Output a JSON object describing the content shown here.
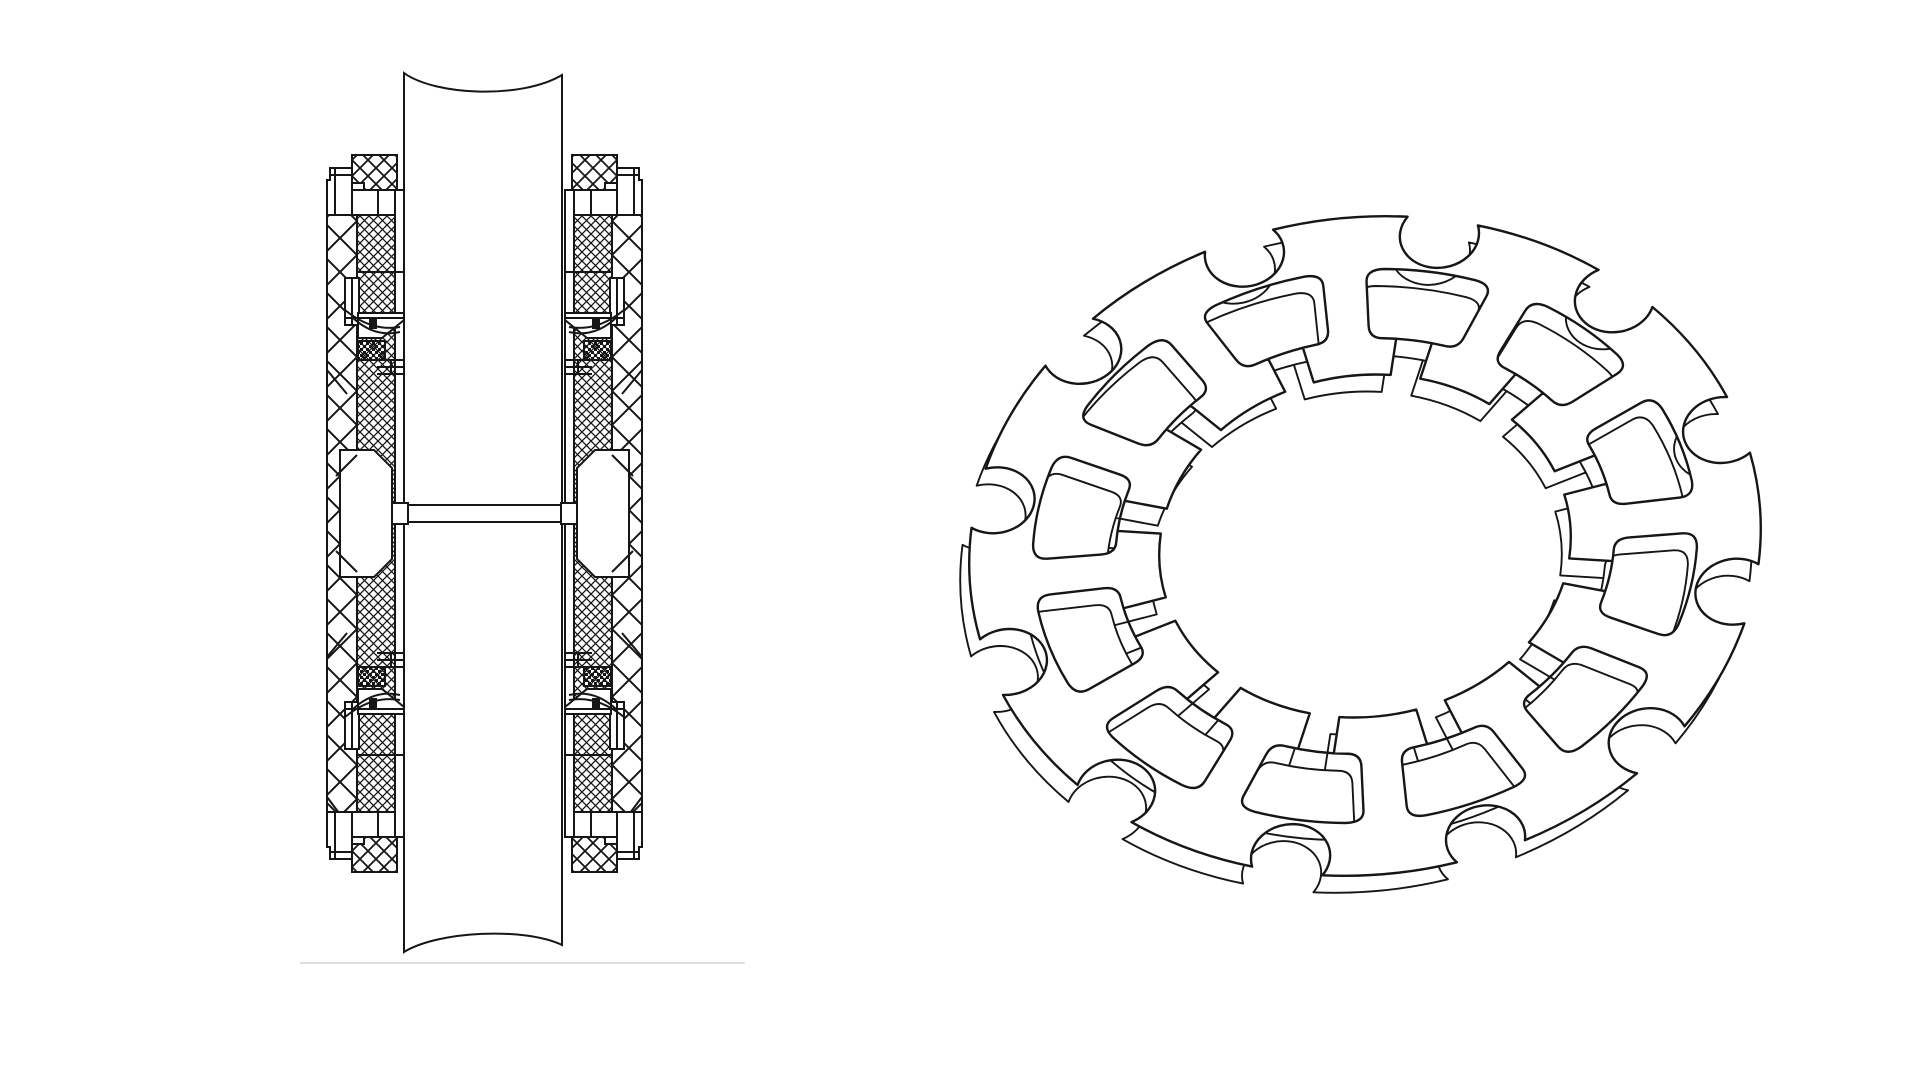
{
  "page": {
    "width": 1920,
    "height": 1080,
    "background": "#ffffff",
    "ink": "#161616"
  },
  "figures": {
    "cross_section": {
      "name": "shaft-seal-assembly-sectional-view",
      "stroke": "#161616",
      "stroke_w": 2,
      "mirror_axis_x": 484.5,
      "mirror_axis_y": 513.5,
      "shaft": {
        "d": "M404,73 C436,96 522,99 562,75 L562,945 C524,927 438,931 404,952 Z"
      },
      "patterns": {
        "big": {
          "size": 34,
          "w": 2.0
        },
        "med": {
          "size": 16,
          "w": 1.8
        },
        "fine": {
          "size": 9,
          "w": 1.3
        },
        "stipple": {
          "size": 6
        }
      },
      "half_shapes": [
        {
          "t": "rect",
          "x": 327,
          "y": 215,
          "w": 30,
          "h": 598,
          "f": "big"
        },
        {
          "t": "rect",
          "x": 357,
          "y": 215,
          "w": 38,
          "h": 598,
          "f": "fine"
        },
        {
          "t": "rect",
          "x": 395,
          "y": 190,
          "w": 9,
          "h": 647,
          "f": "white"
        },
        {
          "t": "path",
          "d": "M340,450 L374,450 L392,468 L392,559 L374,577 L340,577 Z",
          "f": "white"
        },
        {
          "t": "line",
          "x1": 357,
          "y1": 455,
          "x2": 336,
          "y2": 476
        },
        {
          "t": "line",
          "x1": 357,
          "y1": 572,
          "x2": 336,
          "y2": 551
        },
        {
          "t": "line",
          "x1": 327,
          "y1": 370,
          "x2": 347,
          "y2": 394
        },
        {
          "t": "line",
          "x1": 327,
          "y1": 657,
          "x2": 347,
          "y2": 633
        },
        {
          "t": "line",
          "x1": 327,
          "y1": 797,
          "x2": 339,
          "y2": 813
        }
      ],
      "quadrant_shapes": [
        {
          "t": "rect",
          "x": 352,
          "y": 155,
          "w": 45,
          "h": 35,
          "f": "med"
        },
        {
          "t": "rect",
          "x": 352,
          "y": 183,
          "w": 12,
          "h": 7,
          "f": "white"
        },
        {
          "t": "path",
          "d": "M330,168 L352,168 L352,215 L327,215 L327,180 L330,180 Z",
          "f": "white"
        },
        {
          "t": "line",
          "x1": 335,
          "y1": 168,
          "x2": 335,
          "y2": 215
        },
        {
          "t": "line",
          "x1": 330,
          "y1": 175,
          "x2": 352,
          "y2": 175
        },
        {
          "t": "rect",
          "x": 352,
          "y": 190,
          "w": 43,
          "h": 25,
          "f": "white"
        },
        {
          "t": "line",
          "x1": 378,
          "y1": 190,
          "x2": 378,
          "y2": 215
        },
        {
          "t": "line",
          "x1": 357,
          "y1": 272,
          "x2": 404,
          "y2": 272
        },
        {
          "t": "rect",
          "x": 345,
          "y": 278,
          "w": 14,
          "h": 47,
          "f": "white"
        },
        {
          "t": "line",
          "x1": 352,
          "y1": 278,
          "x2": 352,
          "y2": 325
        },
        {
          "t": "path",
          "d": "M358,313 L404,313 L404,320 L382,338 L358,338 Z",
          "f": "white"
        },
        {
          "t": "line",
          "x1": 345,
          "y1": 318,
          "x2": 404,
          "y2": 318
        },
        {
          "t": "rect",
          "x": 369,
          "y": 319,
          "w": 8,
          "h": 10,
          "f": "dark"
        },
        {
          "t": "path",
          "d": "M345,310 Q372,332 400,327",
          "f": "none"
        },
        {
          "t": "path",
          "d": "M352,317 Q374,338 400,332",
          "f": "none"
        },
        {
          "t": "rect",
          "x": 358,
          "y": 341,
          "w": 27,
          "h": 19,
          "f": "stip"
        },
        {
          "t": "line",
          "x1": 377,
          "y1": 360,
          "x2": 404,
          "y2": 360
        },
        {
          "t": "line",
          "x1": 377,
          "y1": 367,
          "x2": 404,
          "y2": 367
        },
        {
          "t": "line",
          "x1": 377,
          "y1": 374,
          "x2": 404,
          "y2": 374
        },
        {
          "t": "line",
          "x1": 391,
          "y1": 360,
          "x2": 391,
          "y2": 374
        }
      ],
      "web_shapes": [
        {
          "t": "rect",
          "x": 392,
          "y": 505,
          "w": 185,
          "h": 17,
          "f": "white"
        },
        {
          "t": "rect",
          "x": 392,
          "y": 503,
          "w": 16,
          "h": 21,
          "f": "white"
        },
        {
          "t": "rect",
          "x": 561,
          "y": 503,
          "w": 16,
          "h": 21,
          "f": "white"
        }
      ],
      "underline": {
        "x1": 300,
        "y1": 963,
        "x2": 745,
        "y2": 963,
        "color": "#e0e0e0",
        "w": 2
      }
    },
    "ring": {
      "name": "slotted-flexible-ring-perspective-view",
      "cx": 1365,
      "cy": 546,
      "radius": 397,
      "squash": 0.827,
      "rotation": -8,
      "teeth": 12,
      "stem0_deg": -87,
      "r_rim": 0.84,
      "r_slot_in": 0.63,
      "r_in": 0.52,
      "slot_outer_half_deg": 11.2,
      "slot_inner_half_deg": 10.4,
      "corner_ang_deg": 3.2,
      "corner_t": 0.18,
      "gap_half_deg": 4.2,
      "crossbar_half_deg": 10.8,
      "notch_half_deg": 5.2,
      "notch_r_frac": 0.1,
      "extrude": {
        "dx": -9,
        "dy": 17
      },
      "stroke": "#161616",
      "front_w": 2.4,
      "back_w": 1.9
    }
  }
}
